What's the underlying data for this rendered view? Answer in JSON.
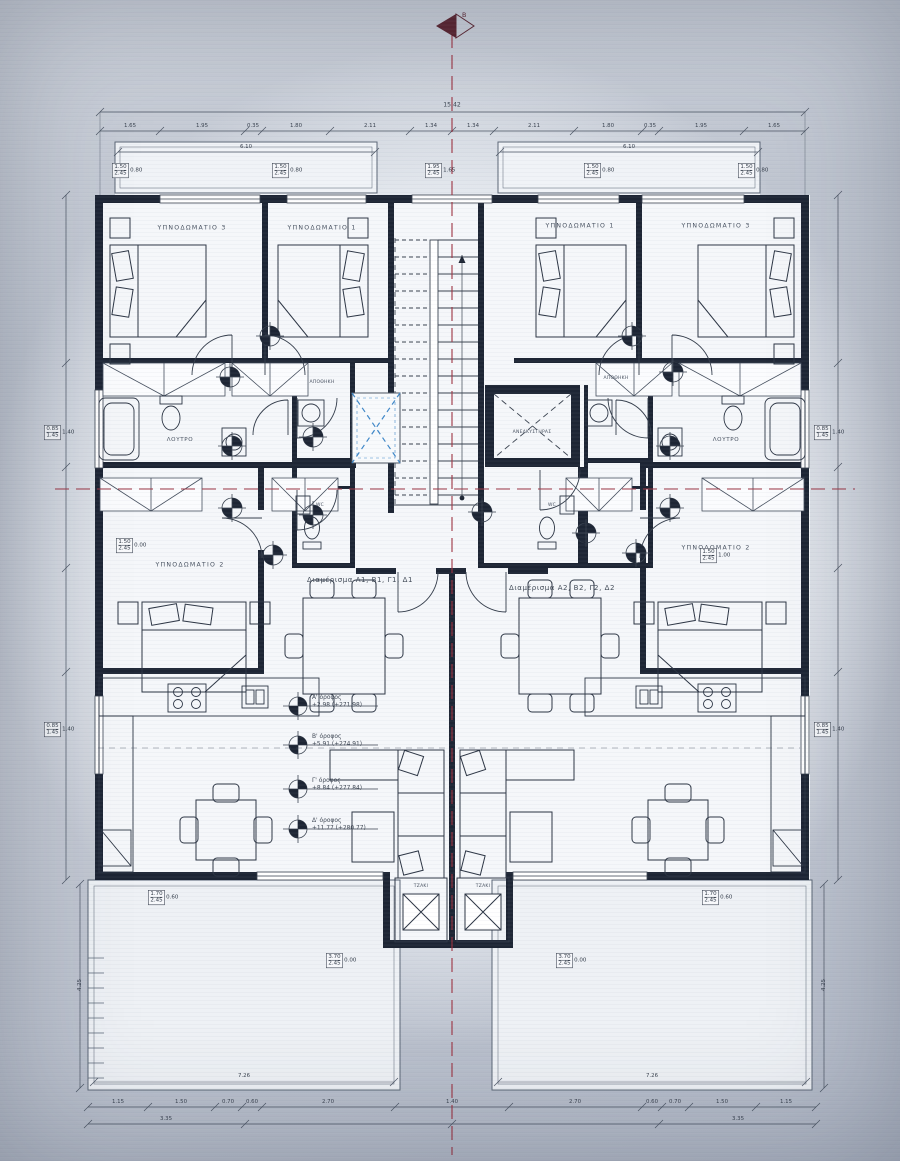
{
  "north_arrow": {
    "label": "Β"
  },
  "rooms": {
    "bedroom3_left": "ΥΠΝΟΔΩΜΑΤΙΟ 3",
    "bedroom1_left": "ΥΠΝΟΔΩΜΑΤΙΟ 1",
    "bedroom1_right": "ΥΠΝΟΔΩΜΑΤΙΟ 1",
    "bedroom3_right": "ΥΠΝΟΔΩΜΑΤΙΟ 3",
    "bedroom2_left": "ΥΠΝΟΔΩΜΑΤΙΟ 2",
    "bedroom2_right": "ΥΠΝΟΔΩΜΑΤΙΟ 2",
    "bath_left": "ΛΟΥΤΡΟ",
    "bath_right": "ΛΟΥΤΡΟ",
    "storage_left": "ΑΠΟΘΗΚΗ",
    "storage_right": "ΑΠΟΘΗΚΗ",
    "wc_left": "WC",
    "wc_right": "WC",
    "elevator": "ΑΝΕΛΚΥΣΤΗΡΑΣ",
    "fireplace_left": "ΤΖΑΚΙ",
    "fireplace_right": "ΤΖΑΚΙ"
  },
  "apartments": {
    "left": "Διαμέρισμα Α1, Β1, Γ1, Δ1",
    "right": "Διαμέρισμα Α2, Β2, Γ2, Δ2"
  },
  "levels": [
    {
      "name": "Α' όροφος",
      "elevation": "+2.98 (+271.98)"
    },
    {
      "name": "Β' όροφος",
      "elevation": "+5.91 (+274.91)"
    },
    {
      "name": "Γ' όροφος",
      "elevation": "+8.84 (+277.84)"
    },
    {
      "name": "Δ' όροφος",
      "elevation": "+11.77 (+280.77)"
    }
  ],
  "dimensions": {
    "overall_top": "15.42",
    "top": [
      "1.65",
      "1.95",
      "0.35",
      "1.80",
      "2.11",
      "1.34",
      "1.34",
      "2.11",
      "1.80",
      "0.35",
      "1.95",
      "1.65"
    ],
    "balcony_left": "6.10",
    "balcony_right": "6.10",
    "bottom": [
      "1.15",
      "1.50",
      "0.70",
      "0.60",
      "2.70",
      "1.40",
      "2.70",
      "0.60",
      "0.70",
      "1.50",
      "1.15"
    ],
    "bottom_sub": [
      "3.35",
      "3.35"
    ],
    "terrace_left": "7.26",
    "terrace_right": "7.26",
    "side_left": "4.25",
    "side_right": "4.25"
  },
  "window_tags": [
    {
      "w": "1.50",
      "h": "2.45",
      "sill": "0.80"
    },
    {
      "w": "1.50",
      "h": "2.45",
      "sill": "0.80"
    },
    {
      "w": "1.95",
      "h": "2.45",
      "sill": "1.65"
    },
    {
      "w": "1.50",
      "h": "2.45",
      "sill": "0.80"
    },
    {
      "w": "1.50",
      "h": "2.45",
      "sill": "0.80"
    },
    {
      "w": "0.85",
      "h": "1.45",
      "sill": "1.40"
    },
    {
      "w": "0.85",
      "h": "1.45",
      "sill": "1.40"
    },
    {
      "w": "0.85",
      "h": "1.45",
      "sill": "1.40"
    },
    {
      "w": "0.85",
      "h": "1.45",
      "sill": "1.40"
    },
    {
      "w": "1.50",
      "h": "2.45",
      "sill": "0.00"
    },
    {
      "w": "1.50",
      "h": "2.45",
      "sill": "1.00"
    },
    {
      "w": "1.70",
      "h": "2.45",
      "sill": "0.60"
    },
    {
      "w": "1.70",
      "h": "2.45",
      "sill": "0.60"
    },
    {
      "w": "3.70",
      "h": "2.45",
      "sill": "0.00"
    },
    {
      "w": "3.70",
      "h": "2.45",
      "sill": "0.00"
    }
  ],
  "colors": {
    "wall_ink": "#1d2534",
    "centerline_red": "#9c3140",
    "shaft_blue": "#3e87c8",
    "paper": "#eef1f5"
  }
}
